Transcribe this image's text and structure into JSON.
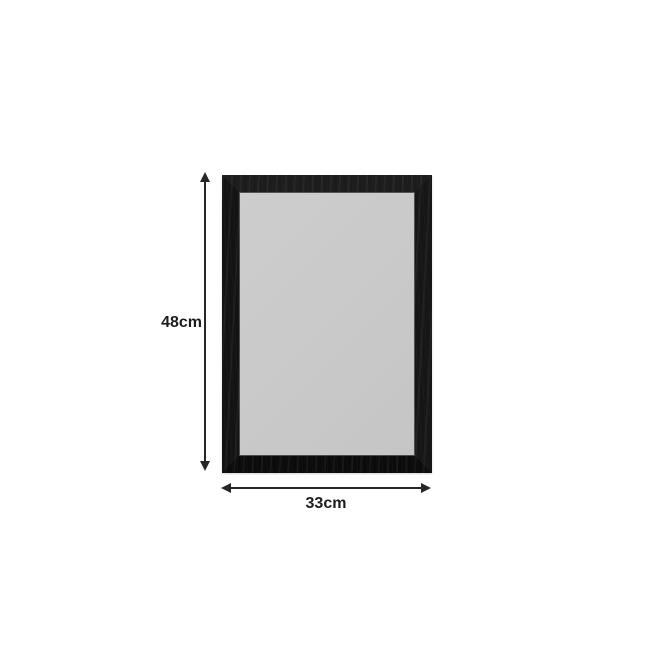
{
  "scene": {
    "background_color": "#ffffff",
    "description": "Product dimension diagram of a black rectangular frame with grey glass"
  },
  "product": {
    "frame_color": "#141414",
    "glass_color": "#c9c9c9"
  },
  "dimensions": {
    "annotation_color": "#262626",
    "text_color": "#1c1c1c",
    "height": {
      "label": "48cm"
    },
    "width": {
      "label": "33cm"
    }
  }
}
